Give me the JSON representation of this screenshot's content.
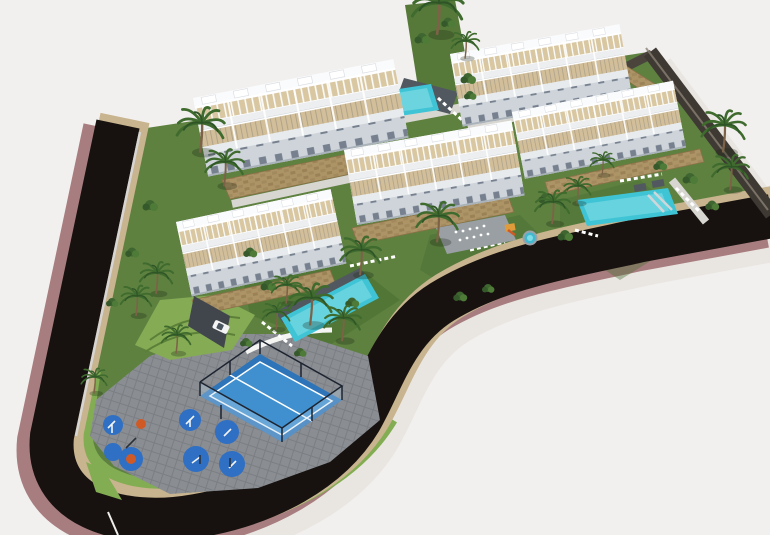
{
  "scene": {
    "type": "aerial-architectural-render",
    "description": "Aerial 3D architectural rendering of a Mediterranean residential development: five white apartment blocks with beige rooftop terraces and pergolas, three turquoise swimming pools with sun loungers, landscaped gardens with palm trees, a fenced blue paddle tennis court, an outdoor fitness playground with blue rubber circles, a grey cobbled plaza, tan stone retaining walls, and a dark asphalt road with mauve sidewalks curving around the site on a white background.",
    "counts": {
      "apartment_blocks": 5,
      "swimming_pools": 3,
      "paddle_courts": 1,
      "playground_circles": 7,
      "palm_trees": 19,
      "cars": 1
    },
    "elements": [
      "apartment-block",
      "rooftop-terrace",
      "swimming-pool",
      "paddle-tennis-court",
      "fitness-playground",
      "fountain-plaza",
      "spa-pool",
      "perimeter-road",
      "sidewalk",
      "stone-retaining-wall",
      "boundary-wall",
      "lawn",
      "hedge",
      "palm-tree",
      "sun-loungers",
      "car",
      "street-lamp"
    ]
  },
  "colors": {
    "bg": "#f2f0ee",
    "shadow": "#e2dfda",
    "road": "#17120f",
    "sidewalk": "#a87d7f",
    "curb": "#c8b48e",
    "hedge": "#83ad52",
    "lawn": "#5e8140",
    "lawnDark": "#496f31",
    "slope": "#86ab55",
    "plaza": "#8a8e93",
    "plazaLine": "#7b7f84",
    "pool": "#3fc4d6",
    "poolLight": "#8fe2e8",
    "deck": "#51585f",
    "court": "#2d74b8",
    "courtInner": "#4090cf",
    "fence": "#1d2430",
    "playBlue": "#2f6fc4",
    "playOrange": "#d05a26",
    "building": "#f3f4f6",
    "roofEdge": "#fafbfc",
    "terrace": "#d9c7a2",
    "terrace2": "#d2bf9a",
    "facadeShadow": "#ced4da",
    "windowGlass": "#76808e",
    "walkway": "#d8d6d1",
    "stone": "#ad9466",
    "stoneDark": "#9b8156",
    "boundary": "#3e3933",
    "trunk": "#7d6247",
    "frond": "#3f6b2e",
    "frondDark": "#2f5527",
    "white": "#ffffff"
  }
}
